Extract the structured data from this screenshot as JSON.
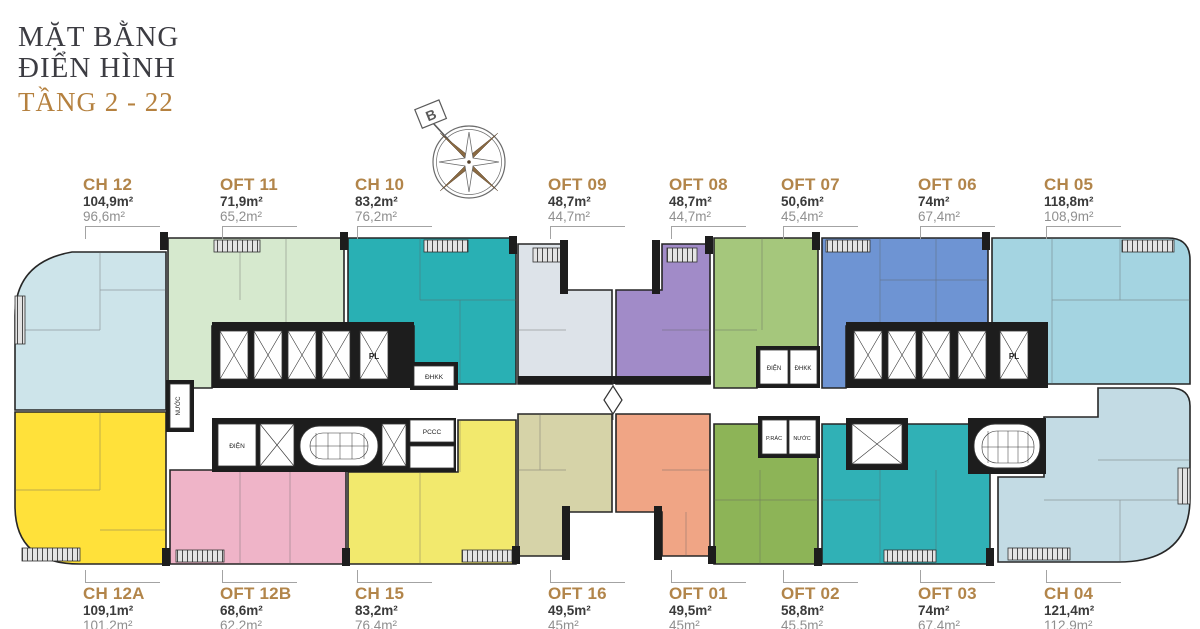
{
  "title": {
    "line1": "MẶT BẰNG",
    "line2": "ĐIỂN HÌNH",
    "line3": "TẦNG 2 - 22"
  },
  "compass": {
    "north_label": "B"
  },
  "units": {
    "top": [
      {
        "name": "CH 12",
        "area_gross": "104,9m²",
        "area_net": "96,6m²",
        "color": "#cde4ea"
      },
      {
        "name": "OFT 11",
        "area_gross": "71,9m²",
        "area_net": "65,2m²",
        "color": "#d6e9ce"
      },
      {
        "name": "CH 10",
        "area_gross": "83,2m²",
        "area_net": "76,2m²",
        "color": "#29b0b4"
      },
      {
        "name": "OFT 09",
        "area_gross": "48,7m²",
        "area_net": "44,7m²",
        "color": "#dde3e9"
      },
      {
        "name": "OFT 08",
        "area_gross": "48,7m²",
        "area_net": "44,7m²",
        "color": "#a18bc8"
      },
      {
        "name": "OFT 07",
        "area_gross": "50,6m²",
        "area_net": "45,4m²",
        "color": "#a5c77c"
      },
      {
        "name": "OFT 06",
        "area_gross": "74m²",
        "area_net": "67,4m²",
        "color": "#6e94d3"
      },
      {
        "name": "CH 05",
        "area_gross": "118,8m²",
        "area_net": "108,9m²",
        "color": "#a4d4e1"
      }
    ],
    "bottom": [
      {
        "name": "CH 12A",
        "area_gross": "109,1m²",
        "area_net": "101,2m²",
        "color": "#ffe13a"
      },
      {
        "name": "OFT 12B",
        "area_gross": "68,6m²",
        "area_net": "62,2m²",
        "color": "#efb4c8"
      },
      {
        "name": "CH 15",
        "area_gross": "83,2m²",
        "area_net": "76,4m²",
        "color": "#f2e96d"
      },
      {
        "name": "OFT 16",
        "area_gross": "49,5m²",
        "area_net": "45m²",
        "color": "#d6d3a8"
      },
      {
        "name": "OFT 01",
        "area_gross": "49,5m²",
        "area_net": "45m²",
        "color": "#f0a585"
      },
      {
        "name": "OFT 02",
        "area_gross": "58,8m²",
        "area_net": "45,5m²",
        "color": "#8db457"
      },
      {
        "name": "OFT 03",
        "area_gross": "74m²",
        "area_net": "67,4m²",
        "color": "#30b1b6"
      },
      {
        "name": "CH 04",
        "area_gross": "121,4m²",
        "area_net": "112,9m²",
        "color": "#c3dbe4"
      }
    ]
  },
  "plan": {
    "rooms": {
      "pl": "PL",
      "dhkk": "ĐHKK",
      "dien": "ĐIỆN",
      "pccc": "PCCC",
      "prac": "P.RÁC",
      "nuoc": "NƯỚC"
    }
  }
}
